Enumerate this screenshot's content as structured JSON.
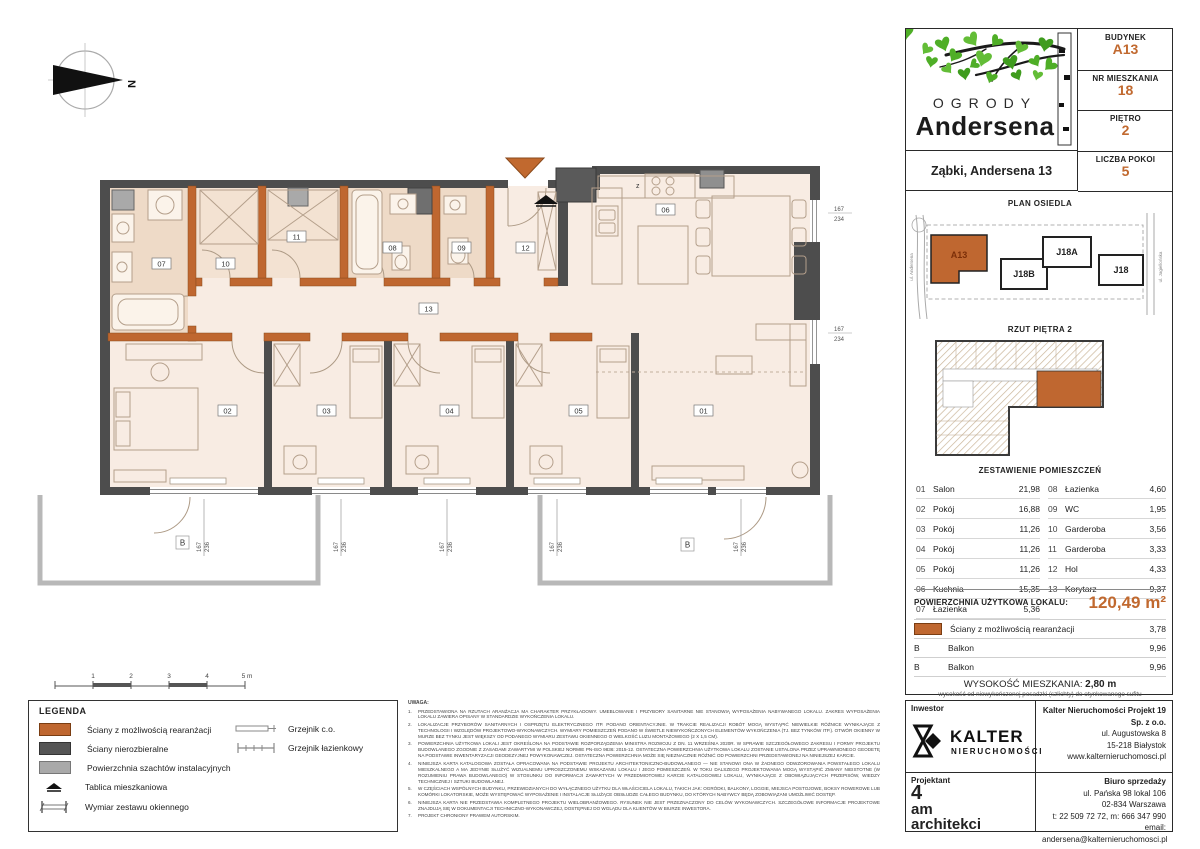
{
  "accent": "#c1692f",
  "compass": {
    "north": "N"
  },
  "header": {
    "rows": [
      {
        "label": "BUDYNEK",
        "value": "A13"
      },
      {
        "label": "NR MIESZKANIA",
        "value": "18"
      },
      {
        "label": "PIĘTRO",
        "value": "2"
      },
      {
        "label": "LICZBA POKOI",
        "value": "5"
      }
    ]
  },
  "logo": {
    "line1": "OGRODY",
    "line2": "Andersena",
    "address": "Ząbki, Andersena 13"
  },
  "site_plan": {
    "title": "PLAN OSIEDLA",
    "buildings": [
      {
        "name": "A13"
      },
      {
        "name": "J18B"
      },
      {
        "name": "J18A"
      },
      {
        "name": "J18"
      }
    ],
    "street_left": "ul. Andersena",
    "street_right": "ul. Jagiellońska"
  },
  "floor_thumb": {
    "title": "RZUT PIĘTRA 2"
  },
  "rooms": {
    "title": "ZESTAWIENIE POMIESZCZEŃ",
    "left": [
      [
        "01",
        "Salon",
        "21,98"
      ],
      [
        "02",
        "Pokój",
        "16,88"
      ],
      [
        "03",
        "Pokój",
        "11,26"
      ],
      [
        "04",
        "Pokój",
        "11,26"
      ],
      [
        "05",
        "Pokój",
        "11,26"
      ],
      [
        "06",
        "Kuchnia",
        "15,35"
      ],
      [
        "07",
        "Łazienka",
        "5,36"
      ]
    ],
    "right": [
      [
        "08",
        "Łazienka",
        "4,60"
      ],
      [
        "09",
        "WC",
        "1,95"
      ],
      [
        "10",
        "Garderoba",
        "3,56"
      ],
      [
        "11",
        "Garderoba",
        "3,33"
      ],
      [
        "12",
        "Hol",
        "4,33"
      ],
      [
        "13",
        "Korytarz",
        "9,37"
      ]
    ]
  },
  "area": {
    "label": "POWIERZCHNIA UŻYTKOWA LOKALU:",
    "value": "120,49 m²"
  },
  "extras": [
    {
      "name": "Ściany z możliwością rearanżacji",
      "value": "3,78"
    },
    {
      "swatch": "B",
      "name": "Balkon",
      "value": "9,96"
    },
    {
      "swatch": "B",
      "name": "Balkon",
      "value": "9,96"
    }
  ],
  "height_info": {
    "label": "WYSOKOŚĆ MIESZKANIA:",
    "value": "2,80 m",
    "note": "wysokość od niewykończonej posadzki (szlichty) do otynkowanego sufitu"
  },
  "legend": {
    "title": "LEGENDA",
    "items": [
      "Ściany z możliwością rearanżacji",
      "Ściany nierozbieralne",
      "Powierzchnia szachtów instalacyjnych",
      "Tablica mieszkaniowa",
      "Wymiar zestawu okiennego"
    ],
    "items_right": [
      "Grzejnik c.o.",
      "Grzejnik łazienkowy"
    ]
  },
  "scalebar": {
    "labels": [
      "1",
      "2",
      "3",
      "4",
      "5 m"
    ]
  },
  "notes": {
    "title": "UWAGA:",
    "items": [
      {
        "n": "1.",
        "t": "PRZEDSTAWIONA NA RZUTACH ARANŻACJA MA CHARAKTER PRZYKŁADOWY. UMEBLOWANIE I PRZYBORY SANITARNE NIE STANOWIĄ WYPOSAŻENIA NABYWANEGO LOKALU. ZAKRES WYPOSAŻENIA LOKALU ZAWIERA OPISANY W STANDARDZIE WYKOŃCZENIA LOKALU."
      },
      {
        "n": "2.",
        "t": "LOKALIZACJE PRZYBORÓW SANITARNYCH I OSPRZĘTU ELEKTRYCZNEGO ITP. PODANO ORIENTACYJNIE. W TRAKCIE REALIZACJI ROBÓT MOGĄ WYSTĄPIĆ NIEWIELKIE RÓŻNICE WYNIKAJĄCE Z TECHNOLOGII I WZGLĘDÓW PROJEKTOWO-WYKONAWCZYCH. WYMIARY POMIESZCZEŃ PODANO W ŚWIETLE NIEWYKOŃCZONYCH ELEMENTÓW WYKOŃCZENIA (TJ. BEZ TYNKÓW ITP.). OTWÓR OKIENNY W MURZE BEZ TYNKU JEST WIĘKSZY OD PODANEGO WYMIARU ZESTAWU OKIENNEGO O WIELKOŚĆ LUZU MONTAŻOWEGO (2 X 1,5 CM)."
      },
      {
        "n": "3.",
        "t": "POWIERZCHNIA UŻYTKOWA LOKALI JEST OKREŚLONA NA PODSTAWIE ROZPORZĄDZENIA MINISTRA ROZWOJU Z DN. 11 WRZEŚNIA 2020R. W SPRAWIE SZCZEGÓŁOWEGO ZAKRESU I FORMY PROJEKTU BUDOWLANEGO ZGODNIE Z ZASADAMI ZAWARTYMI W POLSKIEJ NORMIE PN-ISO 9836: 2015-12. OSTATECZNA POWIERZCHNIA UŻYTKOWA LOKALU ZOSTANIE USTALONA PRZEZ UPRAWNIONEGO GEODETĘ NA PODSTAWIE INWENTARYZACJI GEODEZYJNEJ POWYKONAWCZEJ. OSTATECZNA POWIERZCHNIA MOŻE SIĘ NIEZNACZNIE RÓŻNIĆ OD POWIERZCHNI PRZEDSTAWIONEJ NA NINIEJSZEJ KARCIE."
      },
      {
        "n": "4.",
        "t": "NINIEJSZA KARTA KATALOGOWA ZOSTAŁA OPRACOWANA NA PODSTAWIE PROJEKTU ARCHITEKTONICZNO-BUDOWLANEGO — NIE STANOWI ONA W ŻADNEGO ODWZOROWANIA POWSTAŁEGO LOKALU MIESZKALNEGO A MA JEDYNIE SŁUŻYĆ WIZUALNEMU UPROSZCZONEMU WSKAZANIU LOKALU I JEGO POMIESZCZEŃ. W TOKU DALSZEGO PROJEKTOWANIA MOGĄ WYSTĄPIĆ ZMIANY NIEISTOTNE (W ROZUMIENIU PRAWA BUDOWLANEGO) W STOSUNKU DO INFORMACJI ZAWARTYCH W PRZEDMIOTOWEJ KARCIE KATALOGOWEJ LOKALU, WYNIKAJĄCE Z OBOWIĄZUJĄCYCH PRZEPISÓW, WIEDZY TECHNICZNEJ I SZTUKI BUDOWLANEJ."
      },
      {
        "n": "5.",
        "t": "W CZĘŚCIACH WSPÓLNYCH BUDYNKU, PRZEWIDZIANYCH DO WYŁĄCZNEGO UŻYTKU DLA WŁAŚCICIELA LOKALU, TAKICH JAK: OGRÓDKI, BALKONY, LOGGIE, MIEJSCA POSTOJOWE, BOKSY ROWEROWE LUB KOMÓRKI LOKATORSKIE, MOŻE WYSTĘPOWAĆ WYPOSAŻENIE I INSTALACJE SŁUŻĄCE OBSŁUDZE CAŁEGO BUDYNKU, DO KTÓRYCH NABYWCY BĘDĄ ZOBOWIĄZANI UMOŻLIWIĆ DOSTĘP."
      },
      {
        "n": "6.",
        "t": "NINIEJSZA KARTA NIE PRZEDSTAWIA KOMPLETNEGO PROJEKTU WIELOBRANŻOWEGO. RYSUNEK NIE JEST PRZEZNACZONY DO CELÓW WYKONAWCZYCH. SZCZEGÓŁOWE INFORMACJE PROJEKTOWE ZNAJDUJĄ SIĘ W DOKUMENTACJI TECHNICZNO-WYKONAWCZEJ, DOSTĘPNEJ DO WGLĄDU DLA KLIENTÓW W BIURZE INWESTORA."
      },
      {
        "n": "7.",
        "t": "PROJEKT CHRONIONY PRAWEM AUTORSKIM."
      }
    ]
  },
  "footer": {
    "investor_label": "Inwestor",
    "investor_brand": "KALTER",
    "investor_brand_sub": "NIERUCHOMOŚCI",
    "investor_company": "Kalter Nieruchomości Projekt 19 Sp. z o.o.",
    "investor_lines": [
      "ul. Augustowska 8",
      "15-218 Białystok",
      "www.kalternieruchomosci.pl"
    ],
    "designer_label": "Projektant",
    "designer_1": "4",
    "designer_2": "am",
    "designer_3": "architekci",
    "sales_label": "Biuro sprzedaży",
    "sales_lines": [
      "ul. Pańska 98 lokal 106",
      "02-834 Warszawa",
      "t: 22 509 72 72, m: 666 347 990",
      "email: andersena@kalternieruchomosci.pl"
    ]
  },
  "plan": {
    "labels": {
      "r01": "01",
      "r02": "02",
      "r03": "03",
      "r04": "04",
      "r05": "05",
      "r06": "06",
      "r07": "07",
      "r08": "08",
      "r09": "09",
      "r10": "10",
      "r11": "11",
      "r12": "12",
      "r13": "13",
      "balcony": "B"
    },
    "stove_mark": "z",
    "dims": {
      "rw": "167",
      "rh": "234",
      "bw": "167",
      "bh": "236"
    }
  }
}
